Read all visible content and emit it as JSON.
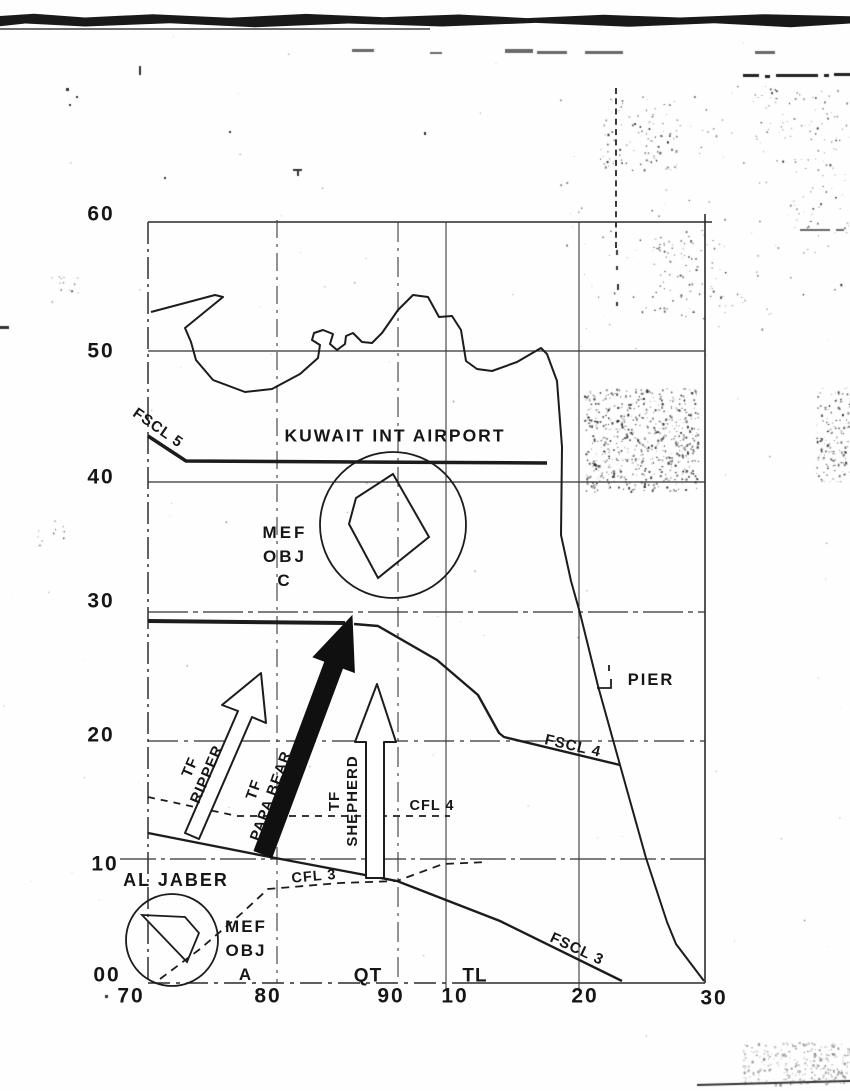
{
  "map": {
    "axis": {
      "y_labels": [
        "60",
        "50",
        "40",
        "30",
        "20",
        "10",
        "00"
      ],
      "x_labels": [
        "70",
        "80",
        "90",
        "10",
        "20",
        "30"
      ],
      "zone_labels": {
        "qt": "QT",
        "tl": "TL"
      }
    },
    "labels": {
      "airport": "KUWAIT INT AIRPORT",
      "pier": "PIER",
      "al_jaber": "AL JABER"
    },
    "objectives": {
      "c": [
        "MEF",
        "OBJ",
        "C"
      ],
      "a": [
        "MEF",
        "OBJ",
        "A"
      ]
    },
    "control_measures": {
      "fscl5": "FSCL 5",
      "fscl4": "FSCL 4",
      "fscl3": "FSCL 3",
      "cfl4": "CFL 4",
      "cfl3": "CFL 3"
    },
    "task_forces": {
      "ripper": {
        "l1": "TF",
        "l2": "RIPPER"
      },
      "papa_bear": {
        "l1": "TF",
        "l2": "PAPA BEAR"
      },
      "shepherd": {
        "l1": "TF",
        "l2": "SHEPHERD"
      }
    },
    "colors": {
      "ink": "#1c1c1c",
      "paper": "#ffffff"
    }
  }
}
